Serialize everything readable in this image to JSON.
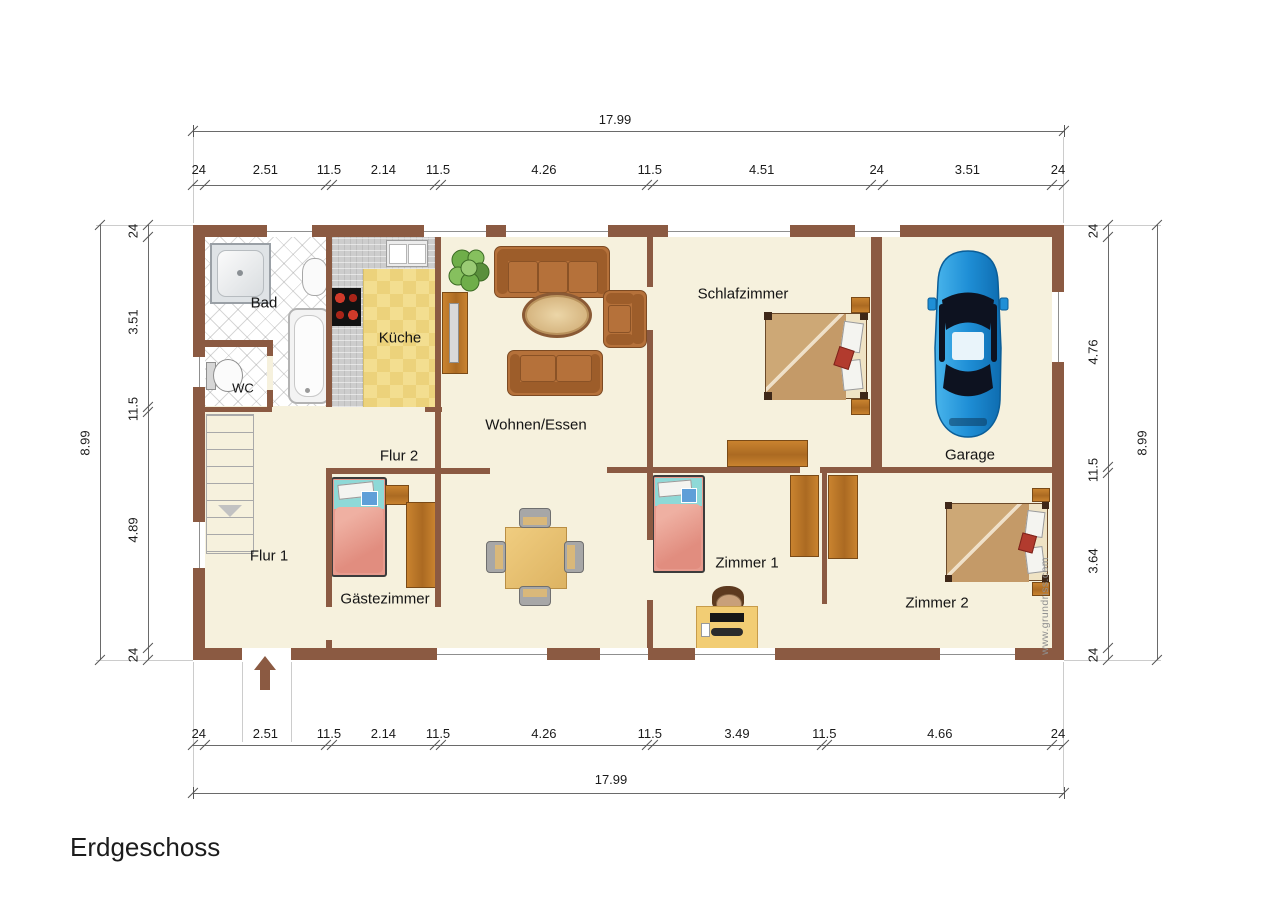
{
  "title": "Erdgeschoss",
  "watermark": "www.grundriss.com",
  "rooms": {
    "bad": "Bad",
    "wc": "WC",
    "kueche": "Küche",
    "wohnen": "Wohnen/Essen",
    "schlafzimmer": "Schlafzimmer",
    "garage": "Garage",
    "flur1": "Flur 1",
    "flur2": "Flur 2",
    "gaestezimmer": "Gästezimmer",
    "zimmer1": "Zimmer 1",
    "zimmer2": "Zimmer 2"
  },
  "dims": {
    "top_total": "17.99",
    "bottom_total": "17.99",
    "left_total": "8.99",
    "right_total": "8.99",
    "top": [
      "24",
      "2.51",
      "11.5",
      "2.14",
      "11.5",
      "4.26",
      "11.5",
      "4.51",
      "24",
      "3.51",
      "24"
    ],
    "bottom": [
      "24",
      "2.51",
      "11.5",
      "2.14",
      "11.5",
      "4.26",
      "11.5",
      "3.49",
      "11.5",
      "4.66",
      "24"
    ],
    "left": [
      "24",
      "3.51",
      "11.5",
      "4.89",
      "24"
    ],
    "right": [
      "24",
      "4.76",
      "11.5",
      "3.64",
      "24"
    ]
  },
  "colors": {
    "wall_brown": "#8b5a42",
    "floor_cream": "#f6f1dd",
    "wood": "#c9832f",
    "sofa_brown": "#b5713a",
    "bed_blanket_pink": "#e79a8d",
    "bed_pillow_teal": "#8ed9d7",
    "double_bed_tan": "#c9a271",
    "kitchen_tile_yellow": "#f3de90",
    "car_blue": "#1f8fd6"
  }
}
